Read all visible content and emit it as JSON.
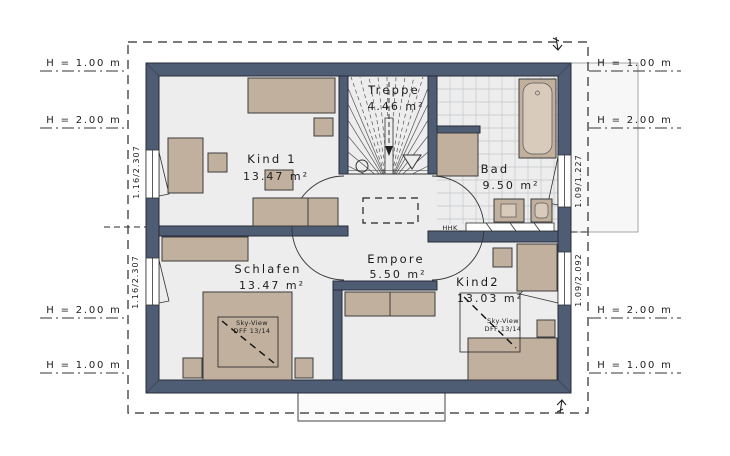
{
  "colors": {
    "wall": "#4e5c74",
    "floor": "#ededed",
    "furniture": "#c2b09e",
    "tub_inner": "#d9cbbc",
    "tile_grid": "#c2c6ca",
    "outline_dashed": "#2a2a2a"
  },
  "rooms": [
    {
      "name": "Kind 1",
      "area": "13.47 m²"
    },
    {
      "name": "Treppe",
      "area": "4.46 m²"
    },
    {
      "name": "Bad",
      "area": "9.50 m²"
    },
    {
      "name": "Schlafen",
      "area": "13.47 m²"
    },
    {
      "name": "Empore",
      "area": "5.50 m²"
    },
    {
      "name": "Kind2",
      "area": "13.03 m²"
    }
  ],
  "height_markers": {
    "left": [
      "H = 1.00 m",
      "H = 2.00 m",
      "H = 2.00 m",
      "H = 1.00 m"
    ],
    "right": [
      "H = 1.00 m",
      "H = 2.00 m",
      "H = 2.00 m",
      "H = 1.00 m"
    ]
  },
  "window_labels": {
    "kind1": "1.16/2.307",
    "schlafen": "1.16/2.307",
    "bad": "1.09/1.227",
    "kind2": "1.09/2.092"
  },
  "annotations": {
    "heater": "HHK",
    "skyview_line1": "Sky-View",
    "skyview_line2": "DFF 13/14"
  }
}
